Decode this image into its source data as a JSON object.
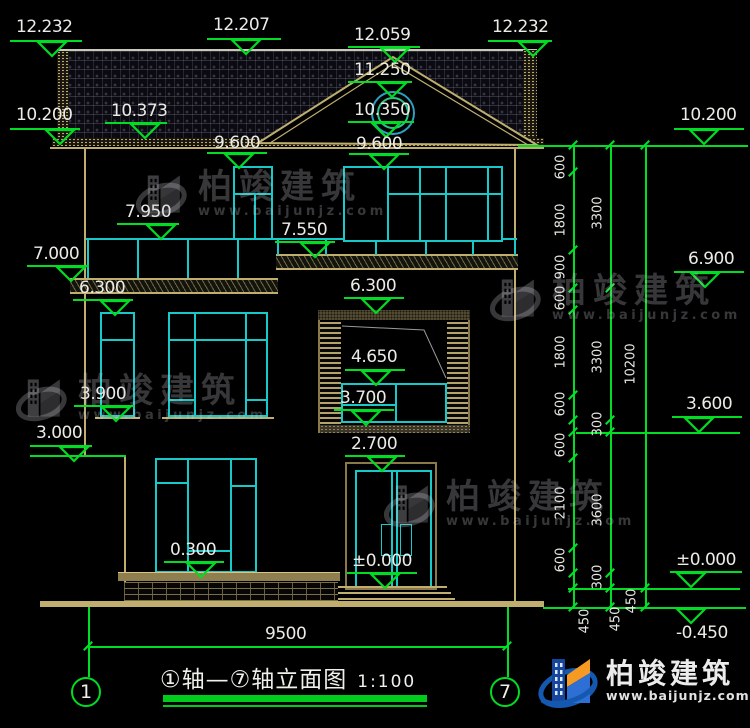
{
  "colors": {
    "dim_green": "#00dd22",
    "frame_cyan": "#17c9c9",
    "wood_tan": "#bfae6e",
    "text_white": "#ecebe6",
    "brand_blue": "#1558b0",
    "brand_orange": "#f59a23"
  },
  "markers": [
    {
      "label": "12.232",
      "tx": 16,
      "ty": 18,
      "x1": 10,
      "x2": 82,
      "ly": 40,
      "cx": 52
    },
    {
      "label": "12.207",
      "tx": 213,
      "ty": 16,
      "x1": 207,
      "x2": 281,
      "ly": 38,
      "cx": 246
    },
    {
      "label": "12.059",
      "tx": 354,
      "ty": 26,
      "x1": 348,
      "x2": 420,
      "ly": 46,
      "cx": 395
    },
    {
      "label": "12.232",
      "tx": 492,
      "ty": 18,
      "x1": 488,
      "x2": 552,
      "ly": 40,
      "cx": 533
    },
    {
      "label": "10.200",
      "tx": 16,
      "ty": 106,
      "x1": 10,
      "x2": 80,
      "ly": 128,
      "cx": 60
    },
    {
      "label": "10.373",
      "tx": 111,
      "ty": 102,
      "x1": 105,
      "x2": 167,
      "ly": 122,
      "cx": 145
    },
    {
      "label": "11.250",
      "tx": 354,
      "ty": 61,
      "x1": 348,
      "x2": 412,
      "ly": 81,
      "cx": 392
    },
    {
      "label": "10.350",
      "tx": 354,
      "ty": 101,
      "x1": 348,
      "x2": 414,
      "ly": 121,
      "cx": 386
    },
    {
      "label": "9.600",
      "tx": 214,
      "ty": 134,
      "x1": 207,
      "x2": 267,
      "ly": 152,
      "cx": 239
    },
    {
      "label": "9.600",
      "tx": 356,
      "ty": 135,
      "x1": 349,
      "x2": 409,
      "ly": 153,
      "cx": 384
    },
    {
      "label": "7.950",
      "tx": 125,
      "ty": 203,
      "x1": 117,
      "x2": 179,
      "ly": 223,
      "cx": 161
    },
    {
      "label": "7.550",
      "tx": 281,
      "ty": 221,
      "x1": 275,
      "x2": 335,
      "ly": 241,
      "cx": 315
    },
    {
      "label": "7.000",
      "tx": 33,
      "ty": 245,
      "x1": 27,
      "x2": 89,
      "ly": 265,
      "cx": 71
    },
    {
      "label": "6.300",
      "tx": 79,
      "ty": 279,
      "x1": 73,
      "x2": 133,
      "ly": 299,
      "cx": 115
    },
    {
      "label": "6.300",
      "tx": 350,
      "ty": 277,
      "x1": 344,
      "x2": 404,
      "ly": 297,
      "cx": 376
    },
    {
      "label": "4.650",
      "tx": 351,
      "ty": 348,
      "x1": 345,
      "x2": 405,
      "ly": 369,
      "cx": 376
    },
    {
      "label": "3.900",
      "tx": 80,
      "ty": 385,
      "x1": 74,
      "x2": 134,
      "ly": 405,
      "cx": 116
    },
    {
      "label": "3.700",
      "tx": 340,
      "ty": 389,
      "x1": 334,
      "x2": 394,
      "ly": 409,
      "cx": 366
    },
    {
      "label": "3.000",
      "tx": 36,
      "ty": 424,
      "x1": 30,
      "x2": 92,
      "ly": 445,
      "cx": 74
    },
    {
      "label": "2.700",
      "tx": 351,
      "ty": 435,
      "x1": 345,
      "x2": 405,
      "ly": 455,
      "cx": 382
    },
    {
      "label": "0.300",
      "tx": 170,
      "ty": 541,
      "x1": 164,
      "x2": 224,
      "ly": 561,
      "cx": 201
    },
    {
      "label": "±0.000",
      "tx": 352,
      "ty": 552,
      "x1": 347,
      "x2": 417,
      "ly": 572,
      "cx": 385
    },
    {
      "label": "10.200",
      "tx": 680,
      "ty": 106,
      "x1": 674,
      "x2": 744,
      "ly": 128,
      "cx": 704
    },
    {
      "label": "6.900",
      "tx": 688,
      "ty": 250,
      "x1": 674,
      "x2": 744,
      "ly": 271,
      "cx": 705
    },
    {
      "label": "3.600",
      "tx": 686,
      "ty": 395,
      "x1": 672,
      "x2": 742,
      "ly": 416,
      "cx": 699
    },
    {
      "label": "±0.000",
      "tx": 676,
      "ty": 551,
      "x1": 670,
      "x2": 742,
      "ly": 571,
      "cx": 691
    },
    {
      "label": "-0.450",
      "tx": 676,
      "ty": 624,
      "x1": 670,
      "x2": 742,
      "ly": 607,
      "cx": 691,
      "below": true
    }
  ],
  "green_lines": [
    {
      "x1": 518,
      "x2": 748,
      "y": 145
    },
    {
      "x1": 576,
      "x2": 740,
      "y": 432
    },
    {
      "x1": 568,
      "x2": 740,
      "y": 588
    },
    {
      "x1": 543,
      "x2": 746,
      "y": 607
    },
    {
      "x1": 30,
      "x2": 126,
      "y": 455
    },
    {
      "x1": 88,
      "x2": 507,
      "y": 646
    }
  ],
  "green_vlines": [
    {
      "x": 573,
      "y1": 145,
      "y2": 607
    },
    {
      "x": 610,
      "y1": 145,
      "y2": 607
    },
    {
      "x": 645,
      "y1": 145,
      "y2": 607
    },
    {
      "x": 88,
      "y1": 607,
      "y2": 677
    },
    {
      "x": 507,
      "y1": 607,
      "y2": 677
    }
  ],
  "chain_labels": [
    {
      "t": "600",
      "x": 561,
      "y": 167
    },
    {
      "t": "1800",
      "x": 561,
      "y": 220
    },
    {
      "t": "900",
      "x": 561,
      "y": 267
    },
    {
      "t": "600",
      "x": 561,
      "y": 298
    },
    {
      "t": "1800",
      "x": 561,
      "y": 352
    },
    {
      "t": "600",
      "x": 561,
      "y": 404
    },
    {
      "t": "600",
      "x": 561,
      "y": 445
    },
    {
      "t": "2100",
      "x": 561,
      "y": 503
    },
    {
      "t": "600",
      "x": 561,
      "y": 560
    },
    {
      "t": "3300",
      "x": 598,
      "y": 213
    },
    {
      "t": "3300",
      "x": 598,
      "y": 357
    },
    {
      "t": "300",
      "x": 598,
      "y": 424
    },
    {
      "t": "3600",
      "x": 598,
      "y": 510
    },
    {
      "t": "300",
      "x": 598,
      "y": 577
    },
    {
      "t": "10200",
      "x": 631,
      "y": 364
    },
    {
      "t": "450",
      "x": 585,
      "y": 621
    },
    {
      "t": "450",
      "x": 616,
      "y": 619
    },
    {
      "t": "450",
      "x": 632,
      "y": 601
    }
  ],
  "ticks": [
    [
      573,
      145
    ],
    [
      573,
      172
    ],
    [
      573,
      250
    ],
    [
      573,
      288
    ],
    [
      573,
      310
    ],
    [
      573,
      395
    ],
    [
      573,
      420
    ],
    [
      573,
      432
    ],
    [
      573,
      458
    ],
    [
      573,
      548
    ],
    [
      573,
      573
    ],
    [
      573,
      588
    ],
    [
      573,
      607
    ],
    [
      610,
      145
    ],
    [
      610,
      288
    ],
    [
      610,
      420
    ],
    [
      610,
      432
    ],
    [
      610,
      573
    ],
    [
      610,
      588
    ],
    [
      610,
      607
    ],
    [
      645,
      145
    ],
    [
      645,
      588
    ],
    [
      645,
      607
    ],
    [
      88,
      646
    ],
    [
      507,
      646
    ]
  ],
  "bottom": {
    "dim": "9500",
    "axis_left": "1",
    "axis_right": "7",
    "title": "①轴—⑦轴立面图",
    "scale": "1:100"
  },
  "watermark": {
    "name": "柏竣建筑",
    "site": "www.baijunjz.com",
    "positions": [
      {
        "x": 136,
        "y": 166
      },
      {
        "x": 16,
        "y": 370
      },
      {
        "x": 490,
        "y": 270
      },
      {
        "x": 384,
        "y": 476
      }
    ]
  },
  "brand": {
    "name": "柏竣建筑",
    "site": "www.baijunjz.com"
  }
}
